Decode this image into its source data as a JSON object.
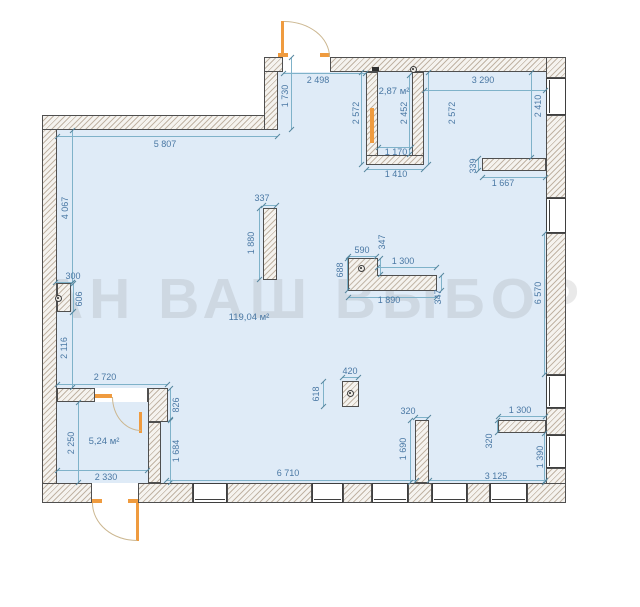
{
  "watermark": "АН ВАШ ВЫБОР",
  "areas": {
    "main": "119,04 м²",
    "closet": "5,24 м²",
    "shaft": "2,87 м²"
  },
  "dims": {
    "d5807": "5 807",
    "d1730": "1 730",
    "d2498": "2 498",
    "d2572l": "2 572",
    "d2452": "2 452",
    "d2572r": "2 572",
    "d1170": "1 170",
    "d1410": "1 410",
    "d3290": "3 290",
    "d2410": "2 410",
    "d339": "339",
    "d1667": "1 667",
    "d6570": "6 570",
    "d4067": "4 067",
    "d300": "300",
    "d606": "606",
    "d2116": "2 116",
    "d2720": "2 720",
    "d826": "826",
    "d1684": "1 684",
    "d2250": "2 250",
    "d2330": "2 330",
    "d6710": "6 710",
    "d3125": "3 125",
    "d420": "420",
    "d618": "618",
    "d320b": "320",
    "d1690": "1 690",
    "d1300r": "1 300",
    "d320r": "320",
    "d1390": "1 390",
    "d337": "337",
    "d1880": "1 880",
    "d590": "590",
    "d347t": "347",
    "d1300c": "1 300",
    "d688": "688",
    "d1890": "1 890",
    "d347r": "347"
  },
  "colors": {
    "interior": "#dfebf7",
    "wall_outline": "#4f4f4f",
    "wall_hatch": "#96806a",
    "dimension_text": "#4a78a4",
    "dimension_line": "#7fb2c9",
    "door": "#ef9b3f"
  }
}
